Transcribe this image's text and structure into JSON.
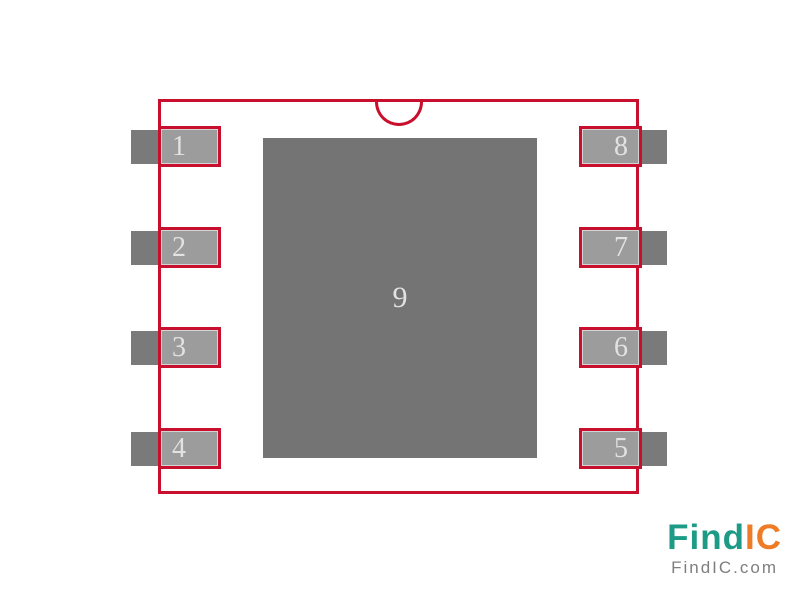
{
  "footprint": {
    "description": "8-pin IC package land pattern with exposed center pad",
    "center_pad": {
      "label": "9"
    },
    "pins": [
      {
        "label": "1",
        "side": "left",
        "row": 1
      },
      {
        "label": "2",
        "side": "left",
        "row": 2
      },
      {
        "label": "3",
        "side": "left",
        "row": 3
      },
      {
        "label": "4",
        "side": "left",
        "row": 4
      },
      {
        "label": "8",
        "side": "right",
        "row": 1
      },
      {
        "label": "7",
        "side": "right",
        "row": 2
      },
      {
        "label": "6",
        "side": "right",
        "row": 3
      },
      {
        "label": "5",
        "side": "right",
        "row": 4
      }
    ]
  },
  "logo": {
    "brand_primary": "Find",
    "brand_secondary": "IC",
    "tagline": "FindIC.com"
  },
  "colors": {
    "outline_red": "#C8102E",
    "pad_fill": "#9C9C9C",
    "lead_fill": "#7A7A7A",
    "center_pad_fill": "#747474",
    "pin_text": "#E2E2E2",
    "logo_teal": "#1E9B87",
    "logo_orange": "#EE7C26",
    "logo_gray": "#7E7E7E"
  }
}
